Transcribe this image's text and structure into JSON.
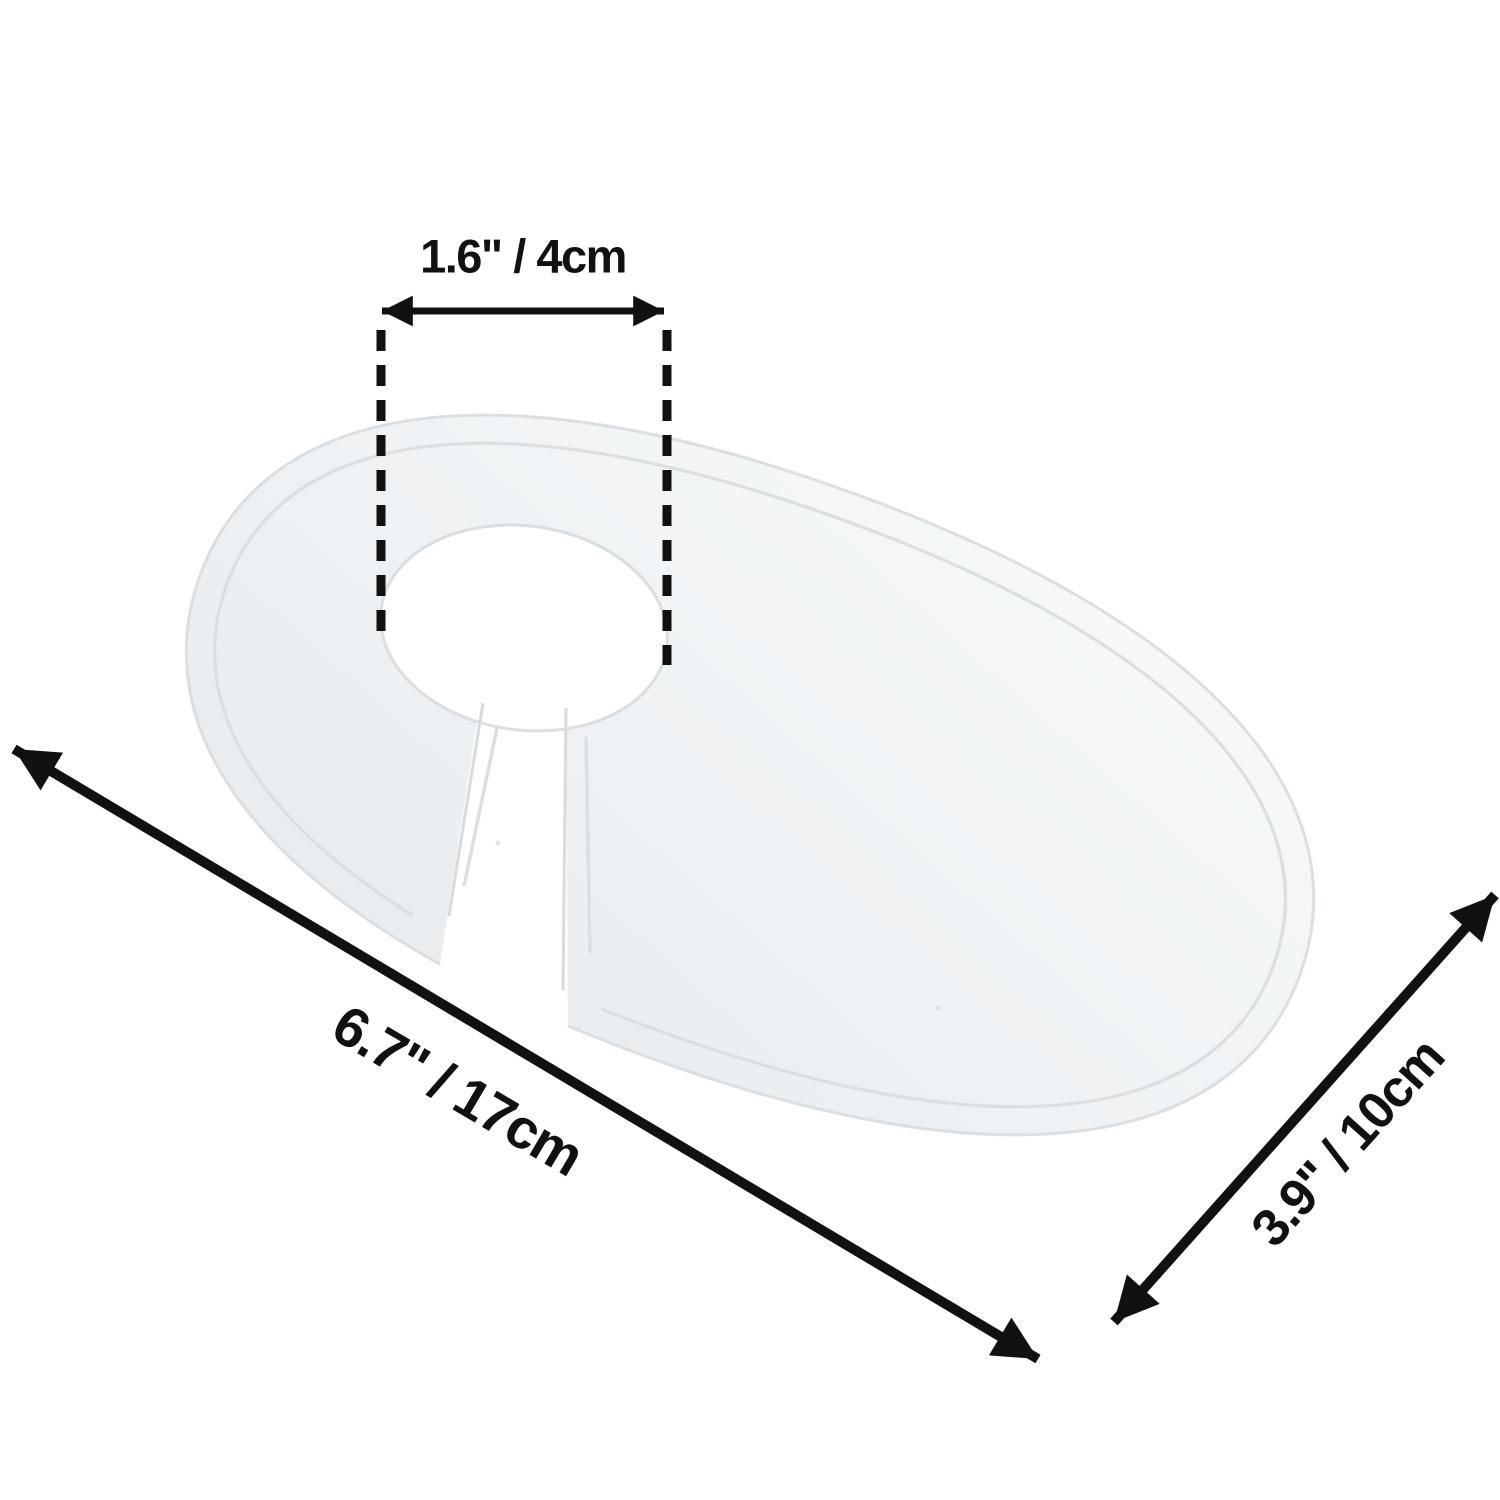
{
  "figure": {
    "type": "product-dimension-diagram",
    "background_color": "#ffffff",
    "annotation_color": "#111111",
    "plate": {
      "description": "white oval keyhole divider plate",
      "fill_color": "#eef1f3",
      "fill_highlight": "#f6f8f9",
      "edge_color": "#dcdfe2"
    },
    "dimensions": {
      "hole_diameter": "1.6\" / 4cm",
      "length": "6.7\" / 17cm",
      "depth": "3.9\" / 10cm"
    }
  }
}
